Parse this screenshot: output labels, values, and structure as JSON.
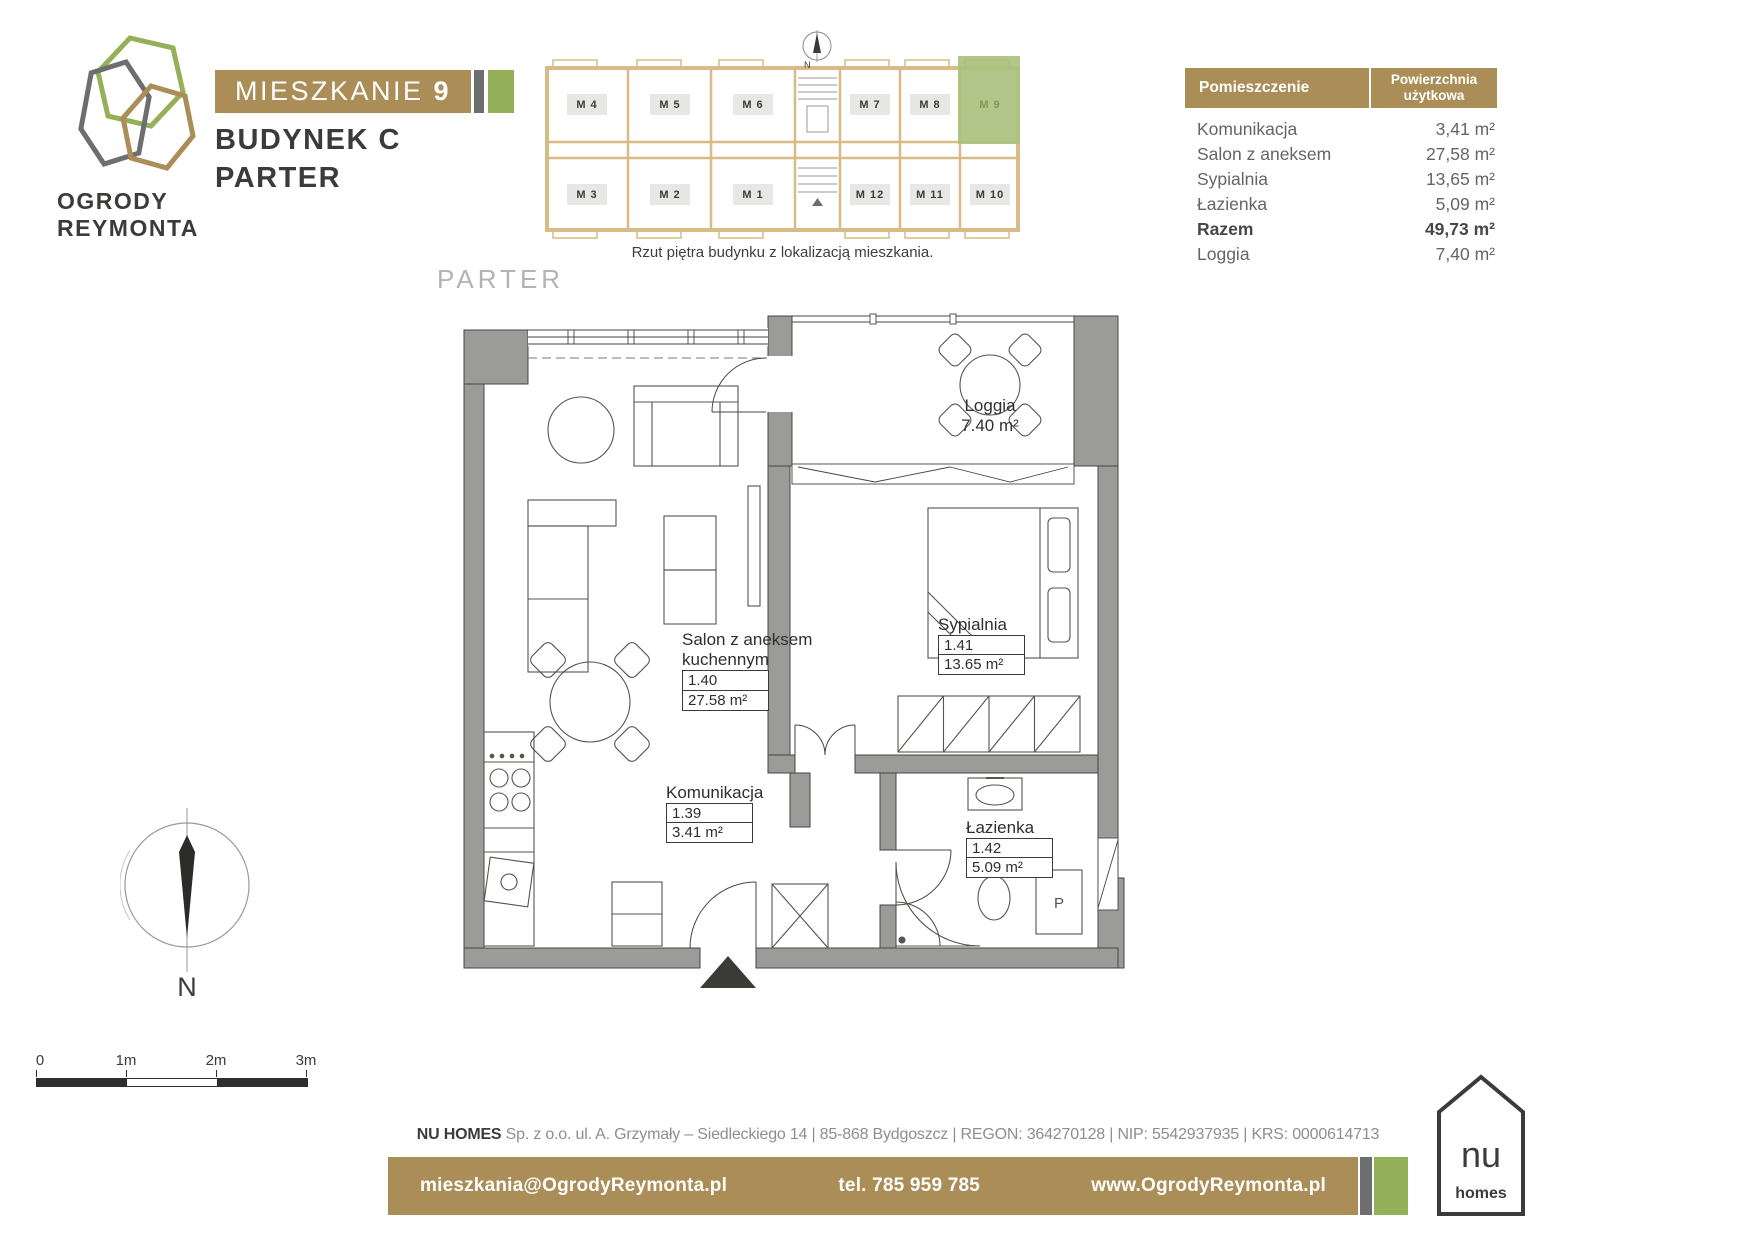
{
  "colors": {
    "gold": "#ab8e57",
    "green": "#94b159",
    "gray": "#6d6e70",
    "wall_gray": "#9b9b9a",
    "highlight_green": "#aac17e"
  },
  "brand": {
    "line1": "OGRODY",
    "line2": "REYMONTA"
  },
  "header": {
    "apartment_word": "MIESZKANIE",
    "apartment_number": "9",
    "building_word": "BUDYNEK",
    "building_letter": "C",
    "floor_word": "PARTER"
  },
  "overview": {
    "caption": "Rzut piętra budynku z lokalizacją mieszkania.",
    "north": "N",
    "highlighted_unit": "M 9",
    "units_top": [
      "M 4",
      "M 5",
      "M 6",
      "M 7",
      "M 8",
      "M 9"
    ],
    "units_bottom": [
      "M 3",
      "M 2",
      "M 1",
      "M 12",
      "M 11",
      "M 10"
    ]
  },
  "table": {
    "header": {
      "room": "Pomieszczenie",
      "area_line1": "Powierzchnia",
      "area_line2": "użytkowa"
    },
    "rows": [
      {
        "room": "Komunikacja",
        "area": "3,41 m²"
      },
      {
        "room": "Salon z aneksem",
        "area": "27,58 m²"
      },
      {
        "room": "Sypialnia",
        "area": "13,65 m²"
      },
      {
        "room": "Łazienka",
        "area": "5,09 m²"
      },
      {
        "room": "Razem",
        "area": "49,73 m²"
      },
      {
        "room": "Loggia",
        "area": "7,40 m²"
      }
    ]
  },
  "plan": {
    "floor_label": "PARTER",
    "washer_marker": "P",
    "rooms": {
      "loggia": {
        "name": "Loggia",
        "area": "7.40 m²"
      },
      "salon": {
        "line1": "Salon z aneksem",
        "line2": "kuchennym",
        "number": "1.40",
        "area": "27.58 m²"
      },
      "sypialnia": {
        "name": "Sypialnia",
        "number": "1.41",
        "area": "13.65 m²"
      },
      "komunikacja": {
        "name": "Komunikacja",
        "number": "1.39",
        "area": "3.41 m²"
      },
      "lazienka": {
        "name": "Łazienka",
        "number": "1.42",
        "area": "5.09 m²"
      }
    }
  },
  "compass": {
    "north": "N"
  },
  "scalebar": {
    "labels": [
      "0",
      "1m",
      "2m",
      "3m"
    ]
  },
  "footer": {
    "company_name": "NU HOMES",
    "company_details": " Sp. z o.o.  ul. A. Grzymały – Siedleckiego 14   |   85-868 Bydgoszcz   |   REGON: 364270128   |   NIP: 5542937935   |   KRS: 0000614713",
    "email": "mieszkania@OgrodyReymonta.pl",
    "phone": "tel. 785 959 785",
    "website": "www.OgrodyReymonta.pl",
    "logo": {
      "name": "nu",
      "word": "homes"
    }
  }
}
